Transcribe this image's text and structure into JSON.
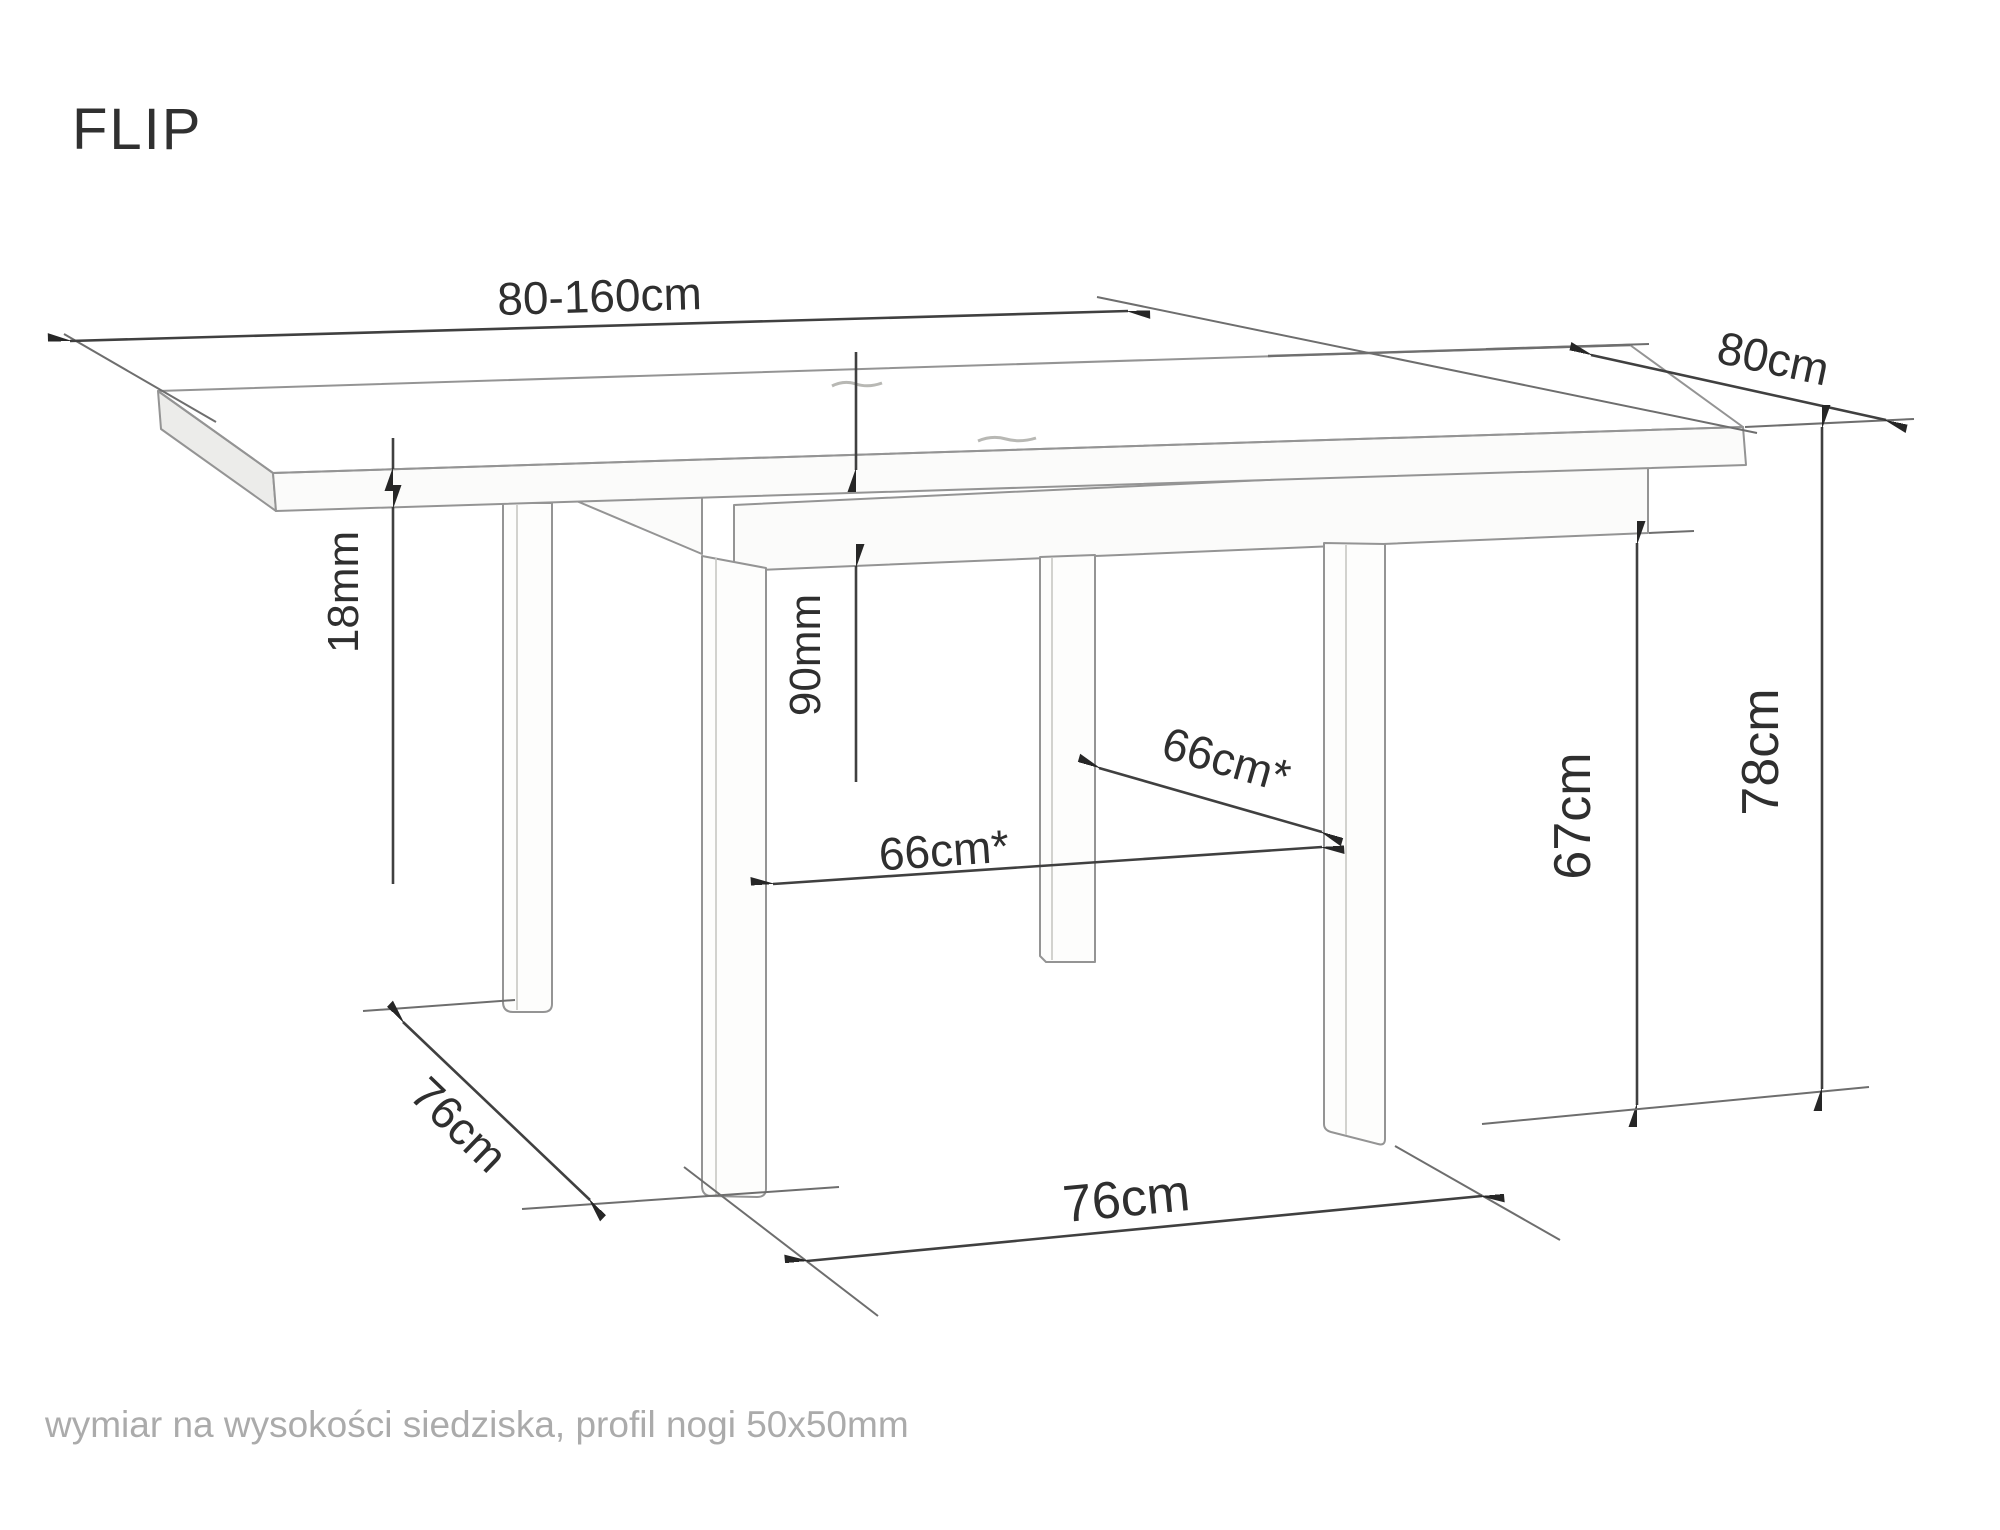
{
  "title": "FLIP",
  "footnote": "wymiar na wysokości siedziska, profil nogi 50x50mm",
  "diagram": {
    "type": "furniture-dimension-drawing",
    "subject": "extendable square dining table, perspective line drawing",
    "dimensions": {
      "length": "80-160cm",
      "depth": "80cm",
      "top_thickness": "18mm",
      "apron_height": "90mm",
      "leg_clearance_diagonal": "66cm*",
      "leg_clearance_front": "66cm*",
      "seat_height_clearance": "67cm",
      "total_height": "78cm",
      "leg_spacing_side": "76cm",
      "leg_spacing_front": "76cm"
    }
  },
  "colors": {
    "ink": "#404040",
    "drawing_outline": "#949494",
    "muted_text": "#ababab",
    "background": "#ffffff"
  }
}
